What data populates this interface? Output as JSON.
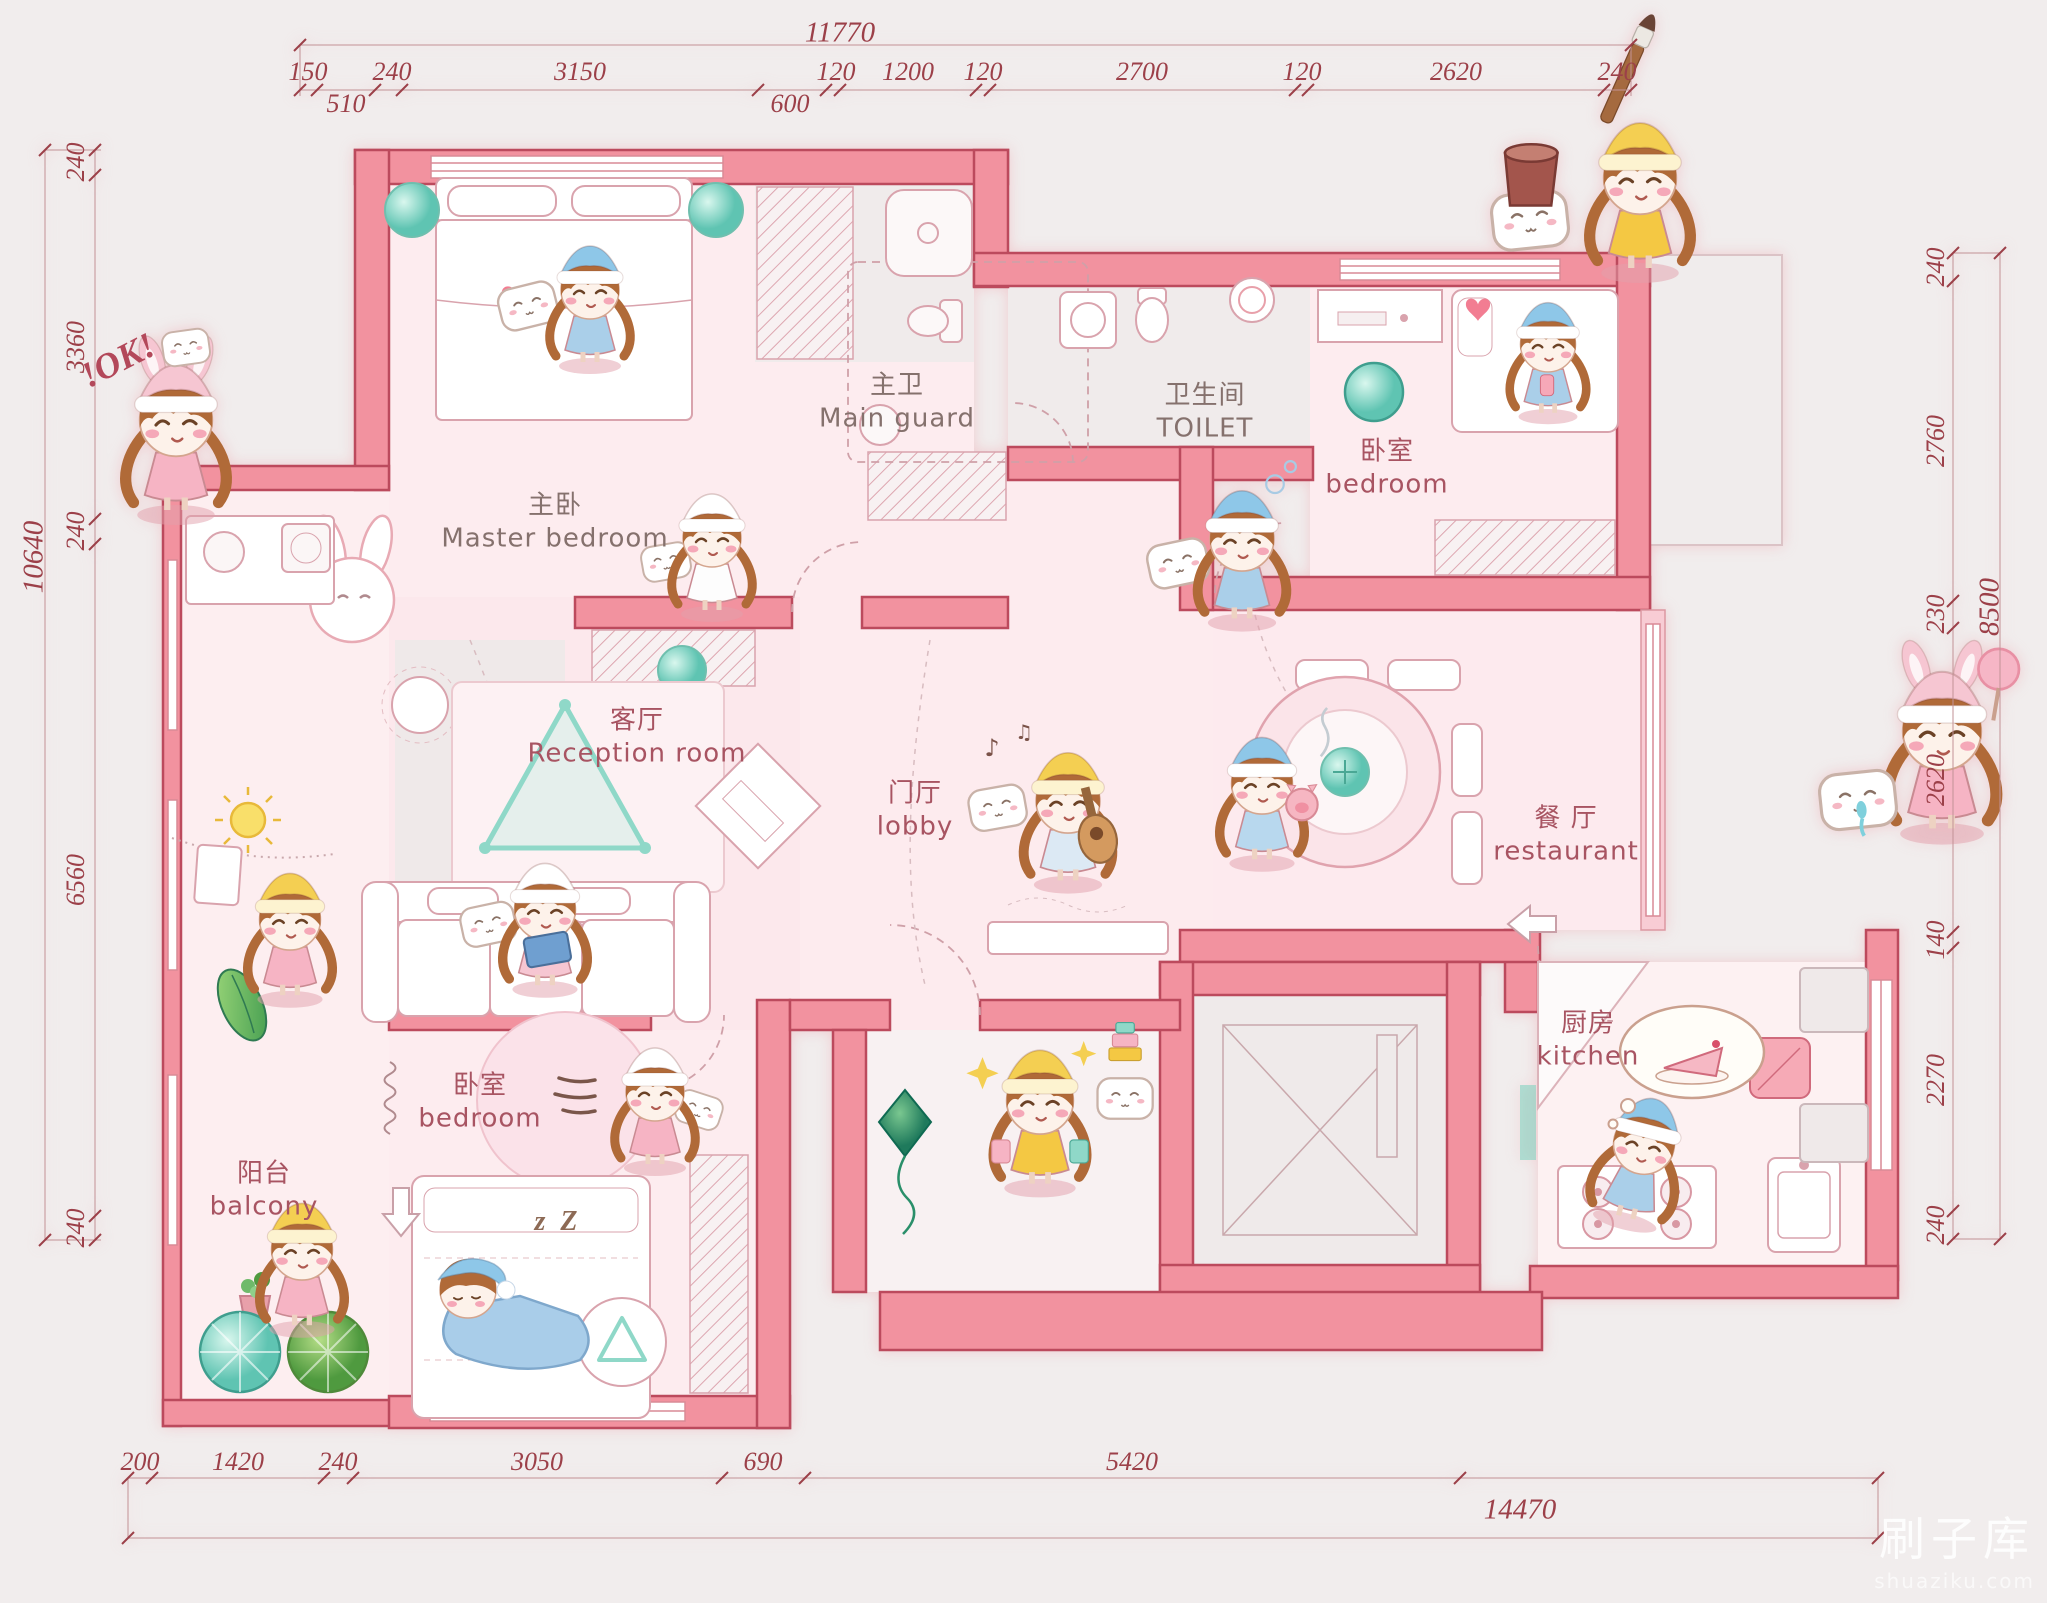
{
  "title": "cartoon-apartment-floor-plan",
  "dims": {
    "top": {
      "overall": "11770",
      "segments": [
        "150",
        "510",
        "240",
        "3150",
        "600",
        "120",
        "1200",
        "120",
        "2700",
        "120",
        "2620",
        "240"
      ]
    },
    "left": {
      "overall": "10640",
      "segments": [
        "240",
        "3360",
        "240",
        "6560",
        "240"
      ]
    },
    "right": {
      "overall": "8500",
      "segments": [
        "240",
        "2760",
        "230",
        "2620",
        "140",
        "2270",
        "240"
      ]
    },
    "bottom": {
      "overall": "14470",
      "segments": [
        "200",
        "1420",
        "240",
        "3050",
        "690",
        "5420"
      ]
    }
  },
  "rooms": [
    {
      "id": "master-bedroom",
      "zh": "主卧",
      "en": "Master bedroom"
    },
    {
      "id": "main-guard",
      "zh": "主卫",
      "en": "Main guard"
    },
    {
      "id": "toilet",
      "zh": "卫生间",
      "en": "TOILET"
    },
    {
      "id": "bedroom-east",
      "zh": "卧室",
      "en": "bedroom"
    },
    {
      "id": "reception-room",
      "zh": "客厅",
      "en": "Reception room"
    },
    {
      "id": "lobby",
      "zh": "门厅",
      "en": "lobby"
    },
    {
      "id": "restaurant",
      "zh": "餐 厅",
      "en": "restaurant"
    },
    {
      "id": "kitchen",
      "zh": "厨房",
      "en": "kitchen"
    },
    {
      "id": "bedroom-south",
      "zh": "卧室",
      "en": "bedroom"
    },
    {
      "id": "balcony",
      "zh": "阳台",
      "en": "balcony"
    }
  ],
  "annotations": {
    "ok": "!OK!",
    "zzz": "z Z",
    "music1": "♪",
    "music2": "♫"
  },
  "watermark": {
    "line1": "刷子库",
    "line2": "shuaziku.com"
  },
  "characters": [
    {
      "id": "girl-ok-pose"
    },
    {
      "id": "girl-sleeping-master-bed"
    },
    {
      "id": "girl-holding-pillow"
    },
    {
      "id": "girl-painter"
    },
    {
      "id": "girl-blowing-bubbles"
    },
    {
      "id": "girl-on-bed-east"
    },
    {
      "id": "girl-playing-guitar"
    },
    {
      "id": "girl-holding-pig"
    },
    {
      "id": "girl-with-crying-pillow"
    },
    {
      "id": "girl-reading-on-sofa"
    },
    {
      "id": "girl-laundry-balcony"
    },
    {
      "id": "girl-watering-plants"
    },
    {
      "id": "girl-running-with-pillow"
    },
    {
      "id": "girl-sleeping-bed-south"
    },
    {
      "id": "girl-shopping-entry"
    },
    {
      "id": "girl-dreaming-of-cake"
    }
  ],
  "palette": {
    "wall": "#f2929f",
    "wallStroke": "#bc4a5d",
    "floorPink": "#fdecef",
    "floorGray": "#f0ebeb",
    "accentTeal": "#5fc4b2",
    "dimText": "#9c4049",
    "labelGray": "#85716d",
    "labelMaroon": "#a85462",
    "hair": "#b06a38",
    "kiteGreen": "#1f7a5c",
    "sunYellow": "#f7d84a"
  }
}
